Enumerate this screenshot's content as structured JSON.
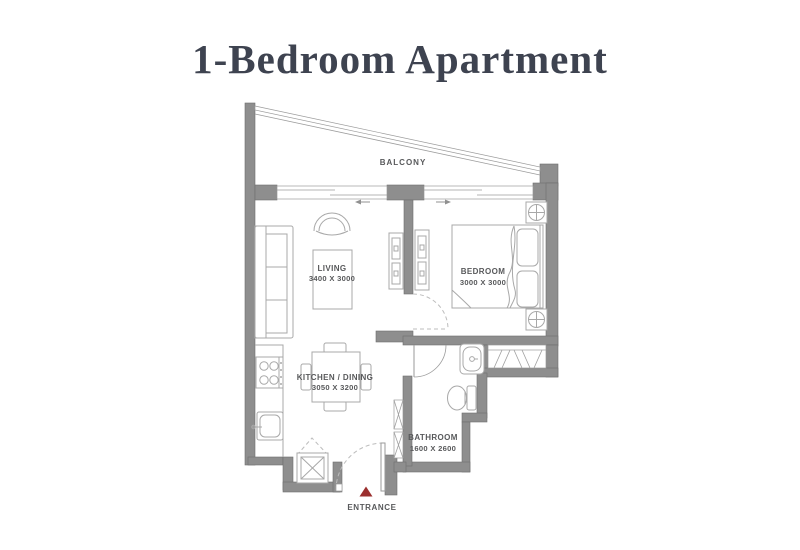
{
  "title": "1-Bedroom Apartment",
  "colors": {
    "wall": "#8e8e8e",
    "furniture_line": "#a8a8a8",
    "label_text": "#58595b",
    "entrance_marker": "#9b2f2e",
    "title_text": "#3e4350"
  },
  "rooms": {
    "balcony": {
      "label": "BALCONY"
    },
    "living": {
      "label": "LIVING",
      "dimensions": "3400 X 3000"
    },
    "bedroom": {
      "label": "BEDROOM",
      "dimensions": "3000 X 3000"
    },
    "kitchen_dining": {
      "label": "KITCHEN / DINING",
      "dimensions": "3050 X 3200"
    },
    "bathroom": {
      "label": "BATHROOM",
      "dimensions": "1600 X 2600"
    }
  },
  "entrance": {
    "label": "ENTRANCE"
  }
}
